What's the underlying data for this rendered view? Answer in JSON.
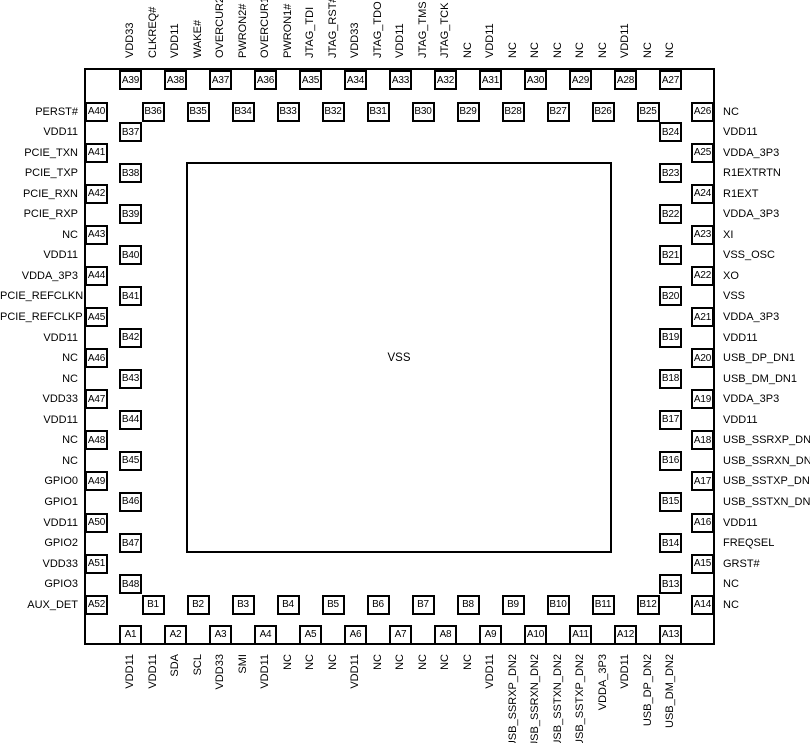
{
  "diagram": {
    "center_label": "VSS",
    "colors": {
      "line": "#000000",
      "background": "#ffffff"
    },
    "edges": {
      "top": {
        "pins": [
          {
            "id": "A39",
            "signal": "VDD33"
          },
          {
            "id": "B36",
            "signal": "CLKREQ#"
          },
          {
            "id": "A38",
            "signal": "VDD11"
          },
          {
            "id": "B35",
            "signal": "WAKE#"
          },
          {
            "id": "A37",
            "signal": "OVERCUR2#"
          },
          {
            "id": "B34",
            "signal": "PWRON2#"
          },
          {
            "id": "A36",
            "signal": "OVERCUR1#"
          },
          {
            "id": "B33",
            "signal": "PWRON1#"
          },
          {
            "id": "A35",
            "signal": "JTAG_TDI"
          },
          {
            "id": "B32",
            "signal": "JTAG_RST#"
          },
          {
            "id": "A34",
            "signal": "VDD33"
          },
          {
            "id": "B31",
            "signal": "JTAG_TDO"
          },
          {
            "id": "A33",
            "signal": "VDD11"
          },
          {
            "id": "B30",
            "signal": "JTAG_TMS"
          },
          {
            "id": "A32",
            "signal": "JTAG_TCK"
          },
          {
            "id": "B29",
            "signal": "NC"
          },
          {
            "id": "A31",
            "signal": "VDD11"
          },
          {
            "id": "B28",
            "signal": "NC"
          },
          {
            "id": "A30",
            "signal": "NC"
          },
          {
            "id": "B27",
            "signal": "NC"
          },
          {
            "id": "A29",
            "signal": "NC"
          },
          {
            "id": "B26",
            "signal": "NC"
          },
          {
            "id": "A28",
            "signal": "VDD11"
          },
          {
            "id": "B25",
            "signal": "NC"
          },
          {
            "id": "A27",
            "signal": "NC"
          }
        ]
      },
      "left": {
        "pins": [
          {
            "id": "A40",
            "signal": "PERST#"
          },
          {
            "id": "B37",
            "signal": "VDD11"
          },
          {
            "id": "A41",
            "signal": "PCIE_TXN"
          },
          {
            "id": "B38",
            "signal": "PCIE_TXP"
          },
          {
            "id": "A42",
            "signal": "PCIE_RXN"
          },
          {
            "id": "B39",
            "signal": "PCIE_RXP"
          },
          {
            "id": "A43",
            "signal": "NC"
          },
          {
            "id": "B40",
            "signal": "VDD11"
          },
          {
            "id": "A44",
            "signal": "VDDA_3P3"
          },
          {
            "id": "B41",
            "signal": "PCIE_REFCLKN"
          },
          {
            "id": "A45",
            "signal": "PCIE_REFCLKP"
          },
          {
            "id": "B42",
            "signal": "VDD11"
          },
          {
            "id": "A46",
            "signal": "NC"
          },
          {
            "id": "B43",
            "signal": "NC"
          },
          {
            "id": "A47",
            "signal": "VDD33"
          },
          {
            "id": "B44",
            "signal": "VDD11"
          },
          {
            "id": "A48",
            "signal": "NC"
          },
          {
            "id": "B45",
            "signal": "NC"
          },
          {
            "id": "A49",
            "signal": "GPIO0"
          },
          {
            "id": "B46",
            "signal": "GPIO1"
          },
          {
            "id": "A50",
            "signal": "VDD11"
          },
          {
            "id": "B47",
            "signal": "GPIO2"
          },
          {
            "id": "A51",
            "signal": "VDD33"
          },
          {
            "id": "B48",
            "signal": "GPIO3"
          },
          {
            "id": "A52",
            "signal": "AUX_DET"
          }
        ]
      },
      "right": {
        "pins": [
          {
            "id": "A26",
            "signal": "NC"
          },
          {
            "id": "B24",
            "signal": "VDD11"
          },
          {
            "id": "A25",
            "signal": "VDDA_3P3"
          },
          {
            "id": "B23",
            "signal": "R1EXTRTN"
          },
          {
            "id": "A24",
            "signal": "R1EXT"
          },
          {
            "id": "B22",
            "signal": "VDDA_3P3"
          },
          {
            "id": "A23",
            "signal": "XI"
          },
          {
            "id": "B21",
            "signal": "VSS_OSC"
          },
          {
            "id": "A22",
            "signal": "XO"
          },
          {
            "id": "B20",
            "signal": "VSS"
          },
          {
            "id": "A21",
            "signal": "VDDA_3P3"
          },
          {
            "id": "B19",
            "signal": "VDD11"
          },
          {
            "id": "A20",
            "signal": "USB_DP_DN1"
          },
          {
            "id": "B18",
            "signal": "USB_DM_DN1"
          },
          {
            "id": "A19",
            "signal": "VDDA_3P3"
          },
          {
            "id": "B17",
            "signal": "VDD11"
          },
          {
            "id": "A18",
            "signal": "USB_SSRXP_DN1"
          },
          {
            "id": "B16",
            "signal": "USB_SSRXN_DN1"
          },
          {
            "id": "A17",
            "signal": "USB_SSTXP_DN1"
          },
          {
            "id": "B15",
            "signal": "USB_SSTXN_DN1"
          },
          {
            "id": "A16",
            "signal": "VDD11"
          },
          {
            "id": "B14",
            "signal": "FREQSEL"
          },
          {
            "id": "A15",
            "signal": "GRST#"
          },
          {
            "id": "B13",
            "signal": "NC"
          },
          {
            "id": "A14",
            "signal": "NC"
          }
        ]
      },
      "bottom": {
        "pins": [
          {
            "id": "A1",
            "signal": "VDD11"
          },
          {
            "id": "B1",
            "signal": "VDD11"
          },
          {
            "id": "A2",
            "signal": "SDA"
          },
          {
            "id": "B2",
            "signal": "SCL"
          },
          {
            "id": "A3",
            "signal": "VDD33"
          },
          {
            "id": "B3",
            "signal": "SMI"
          },
          {
            "id": "A4",
            "signal": "VDD11"
          },
          {
            "id": "B4",
            "signal": "NC"
          },
          {
            "id": "A5",
            "signal": "NC"
          },
          {
            "id": "B5",
            "signal": "NC"
          },
          {
            "id": "A6",
            "signal": "VDD11"
          },
          {
            "id": "B6",
            "signal": "NC"
          },
          {
            "id": "A7",
            "signal": "NC"
          },
          {
            "id": "B7",
            "signal": "NC"
          },
          {
            "id": "A8",
            "signal": "NC"
          },
          {
            "id": "B8",
            "signal": "NC"
          },
          {
            "id": "A9",
            "signal": "VDD11"
          },
          {
            "id": "B9",
            "signal": "USB_SSRXP_DN2"
          },
          {
            "id": "A10",
            "signal": "USB_SSRXN_DN2"
          },
          {
            "id": "B10",
            "signal": "USB_SSTXN_DN2"
          },
          {
            "id": "A11",
            "signal": "USB_SSTXP_DN2"
          },
          {
            "id": "B11",
            "signal": "VDDA_3P3"
          },
          {
            "id": "A12",
            "signal": "VDD11"
          },
          {
            "id": "B12",
            "signal": "USB_DP_DN2"
          },
          {
            "id": "A13",
            "signal": "USB_DM_DN2"
          }
        ]
      }
    }
  }
}
